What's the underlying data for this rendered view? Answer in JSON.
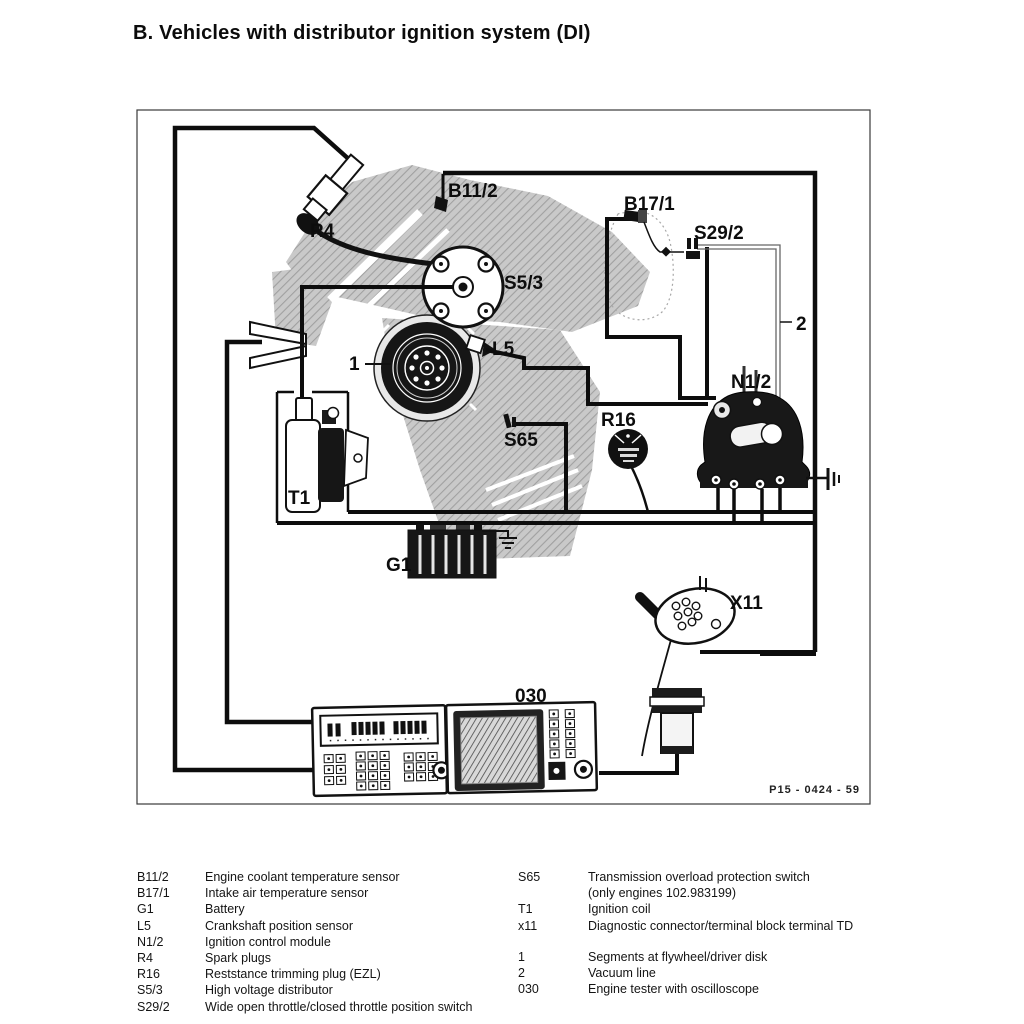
{
  "title": "B. Vehicles with distributor ignition system (DI)",
  "figure": {
    "code": "P15 - 0424 - 59",
    "labels": {
      "r4": "R4",
      "b11_2": "B11/2",
      "b17_1": "B17/1",
      "s29_2": "S29/2",
      "s5_3": "S5/3",
      "l5": "L5",
      "one": "1",
      "two": "2",
      "s65": "S65",
      "n1_2": "N1/2",
      "r16": "R16",
      "t1": "T1",
      "g1": "G1",
      "x11": "X11",
      "tester": "030"
    }
  },
  "legend": {
    "left": [
      {
        "code": "B11/2",
        "desc": "Engine coolant temperature sensor"
      },
      {
        "code": "B17/1",
        "desc": "Intake air temperature sensor"
      },
      {
        "code": "G1",
        "desc": "Battery"
      },
      {
        "code": "L5",
        "desc": "Crankshaft position sensor"
      },
      {
        "code": "N1/2",
        "desc": "Ignition control module"
      },
      {
        "code": "R4",
        "desc": "Spark plugs"
      },
      {
        "code": "R16",
        "desc": "Reststance trimming plug (EZL)"
      },
      {
        "code": "S5/3",
        "desc": "High voltage distributor"
      },
      {
        "code": "S29/2",
        "desc": "Wide open throttle/closed throttle position switch"
      }
    ],
    "right": [
      {
        "code": "S65",
        "desc": "Transmission overload protection switch"
      },
      {
        "code": "",
        "desc": "(only engines 102.983199)"
      },
      {
        "code": "T1",
        "desc": "Ignition coil"
      },
      {
        "code": "x11",
        "desc": "Diagnostic connector/terminal block terminal TD"
      },
      {
        "code": "1",
        "desc": "Segments at flywheel/driver disk"
      },
      {
        "code": "2",
        "desc": "Vacuum line"
      },
      {
        "code": "030",
        "desc": "Engine tester with oscilloscope"
      }
    ]
  }
}
